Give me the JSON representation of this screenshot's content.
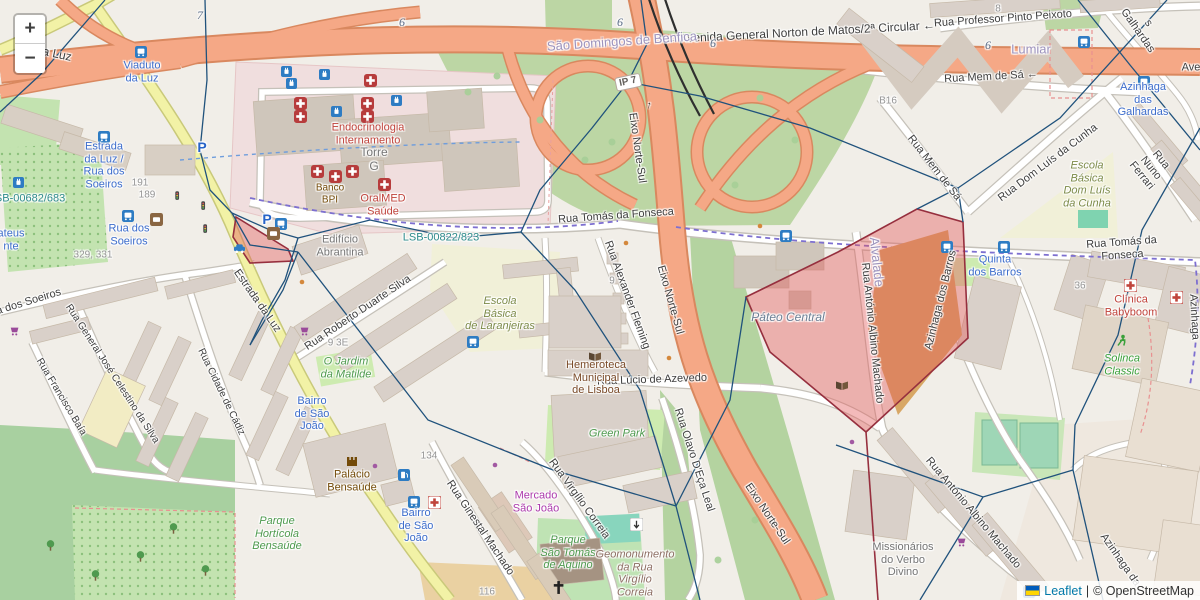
{
  "controls": {
    "zoom_in": "+",
    "zoom_out": "−"
  },
  "attribution": {
    "leaflet": "Leaflet",
    "separator": "|",
    "osm": "© OpenStreetMap"
  },
  "colors": {
    "highlight_fill": "#e25b5b",
    "highlight_stroke": "#962f3e",
    "overlay_line": "#20527c",
    "trunk_road": "#f5a886",
    "secondary_road": "#f2f2a6",
    "transit_label": "#3d6dcc"
  },
  "icons": {
    "bus": "bus-stop-icon",
    "hospital": "hospital-icon",
    "clinic": "clinic-cross-icon",
    "charging": "charging-station-icon",
    "car": "car-sharing-icon",
    "cart": "supermarket-icon",
    "book": "library-icon",
    "castle": "castle-icon",
    "cross": "church-icon",
    "runner": "fitness-icon",
    "fuel": "fuel-icon",
    "signal": "traffic-signal-icon",
    "tree": "tree-icon"
  },
  "labels": [
    {
      "t": "← Avenida General Norton de Matos/2ª Circular ←"
    },
    {
      "t": "Rua Professor Pinto Peixoto"
    },
    {
      "t": "Rua Mem de Sá ←"
    },
    {
      "t": "Rua Mem de Sá"
    },
    {
      "t": "Rua Tomás da Fonseca"
    },
    {
      "t": "Rua Tomás da Fonseca"
    },
    {
      "t": "Rua Dom Luís da Cunha"
    },
    {
      "t": "Rua Nuno Ferrari"
    },
    {
      "t": "s Galhardas"
    },
    {
      "t": "Azinhaga"
    },
    {
      "t": "Azinhaga da"
    },
    {
      "t": "Ave"
    },
    {
      "t": "Eixo Norte-Sul"
    },
    {
      "t": "Eixo Norte-Sul"
    },
    {
      "t": "Eixo Norte-Sul"
    },
    {
      "t": "Estrada da Luz"
    },
    {
      "t": "uto da Luz"
    },
    {
      "t": "Rua dos Soeiros"
    },
    {
      "t": "Rua General José Celestino da Silva"
    },
    {
      "t": "Rua Francisco Baía"
    },
    {
      "t": "Rua Cidade de Cádiz"
    },
    {
      "t": "Rua Roberto Duarte Silva"
    },
    {
      "t": "Rua Alexander Fleming"
    },
    {
      "t": "Rua Lúcio de Azevedo"
    },
    {
      "t": "Rua Olavo D'Eça Leal"
    },
    {
      "t": "Rua Virgílio Correia"
    },
    {
      "t": "Rua Ginestal Machado"
    },
    {
      "t": "Rua António Albino Machado"
    },
    {
      "t": "Rua António Albino Machado"
    },
    {
      "t": "Azinhaga dos Barros"
    },
    {
      "t": "São Domingos de Benfica"
    },
    {
      "t": "Lumiar"
    },
    {
      "t": "Alvalade"
    },
    {
      "t": "Viaduto\nda Luz"
    },
    {
      "t": "Estrada\nda Luz /\nRua dos\nSoeiros"
    },
    {
      "t": "Rua dos\nSoeiros"
    },
    {
      "t": "ateus\nnte"
    },
    {
      "t": "Azinhaga\ndas Galhardas"
    },
    {
      "t": "Quinta\ndos Barros"
    },
    {
      "t": "Bairro\nde São\nJoão"
    },
    {
      "t": "Bairro\nde São\nJoão"
    },
    {
      "t": "LSB-00822/823"
    },
    {
      "t": "LSB-00682/683"
    },
    {
      "t": "Endocrinologia\nInternamento"
    },
    {
      "t": "OralMED\nSaúde"
    },
    {
      "t": "Clínica\nBabyboom"
    },
    {
      "t": "Torre\nG"
    },
    {
      "t": "Edifício\nAbrantina"
    },
    {
      "t": "Banco\nBPI"
    },
    {
      "t": "Hemeroteca\nMunicipal\nde Lisboa"
    },
    {
      "t": "Escola\nBásica\nde Laranjeiras"
    },
    {
      "t": "Escola\nBásica\nDom Luís\nda Cunha"
    },
    {
      "t": "O Jardim\nda Matilde"
    },
    {
      "t": "Green Park"
    },
    {
      "t": "Parque\nHortícola\nBensaúde"
    },
    {
      "t": "Parque\nSão Tomás\nde Aquino"
    },
    {
      "t": "Geomonumento\nda Rua\nVirgílio\nCorreia"
    },
    {
      "t": "Palácio\nBensaúde"
    },
    {
      "t": "Mercado\nSão João"
    },
    {
      "t": "Missionários\ndo Verbo\nDivino"
    },
    {
      "t": "Solinca\nClassic"
    },
    {
      "t": "Páteo Central"
    },
    {
      "t": "IP 7"
    },
    {
      "t": "7"
    },
    {
      "t": "6"
    },
    {
      "t": "6"
    },
    {
      "t": "6"
    },
    {
      "t": "6"
    },
    {
      "t": "B16"
    },
    {
      "t": "8"
    },
    {
      "t": "191"
    },
    {
      "t": "189"
    },
    {
      "t": "329, 331"
    },
    {
      "t": "134"
    },
    {
      "t": "116"
    },
    {
      "t": "36"
    },
    {
      "t": "P"
    },
    {
      "t": "P"
    },
    {
      "t": "9 3E"
    },
    {
      "t": "9"
    },
    {
      "t": "↑"
    }
  ]
}
